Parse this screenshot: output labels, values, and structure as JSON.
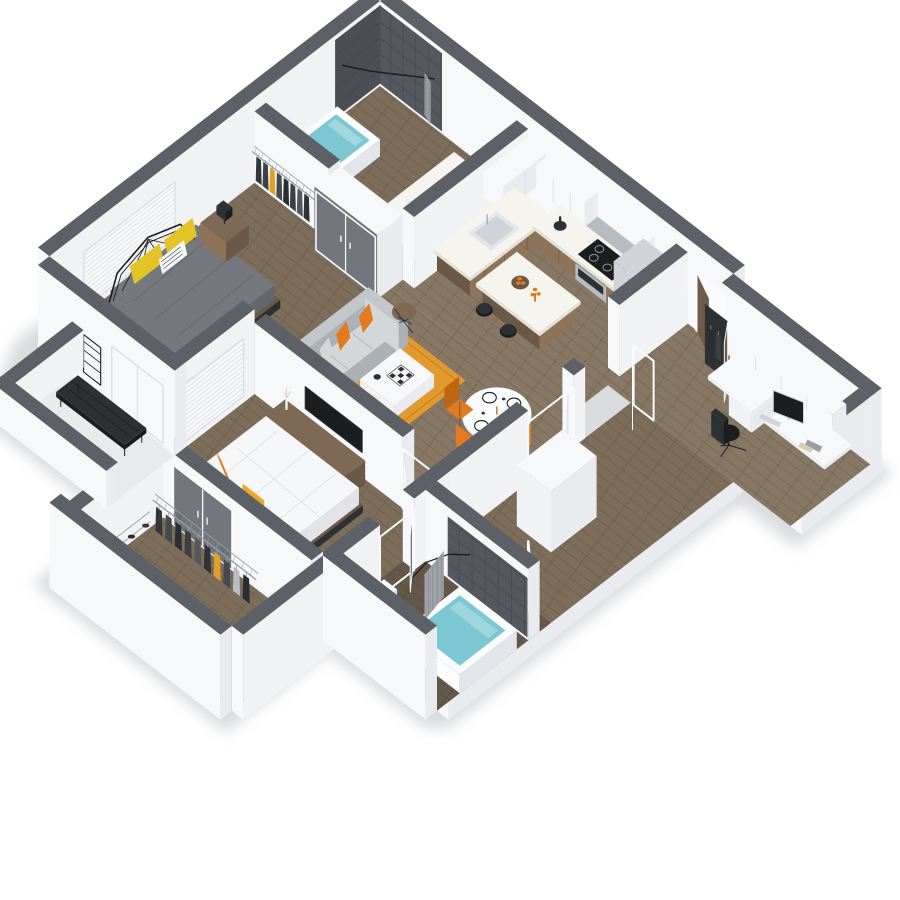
{
  "scene": {
    "type": "isometric-3d-floor-plan",
    "background": "#ffffff"
  },
  "palette": {
    "shadow": "#b9bdc1",
    "cap": "#5d6167",
    "cap_dk": "#53575d",
    "wall_lt": "#f7f8f9",
    "wall_md": "#e9ebee",
    "wall_dk": "#dcdfe3",
    "wall_face": "#f1f2f4",
    "floor_a": "#7d6e5c",
    "floor_b": "#877765",
    "floor_dark": "#64584a",
    "balcony": "#e8eaec",
    "tile_dark": "#55595f",
    "tile_dk2": "#4b4f55",
    "tile_line": "#45494f",
    "water": "#7cc7d2",
    "water_hi": "#b8e2e8",
    "white_fix": "#fbfcfd",
    "fix_shade": "#e2e5e9",
    "wood_cab": "#8d7458",
    "wood_dk": "#6b5947",
    "wood_mid": "#7e6a54",
    "counter": "#f6f4ee",
    "counter_sd": "#e5e2d8",
    "steel": "#b7bcc1",
    "steel_dk": "#989ea5",
    "steel_lt": "#d0d4d8",
    "black": "#1b1d1f",
    "dark": "#2e3134",
    "sofa": "#c3c7cb",
    "sofa_dk": "#acb1b6",
    "sofa_lt": "#d4d7da",
    "orange": "#e27b1e",
    "orange_dk": "#c2650f",
    "amber": "#eda82c",
    "yellow": "#e3c428",
    "rug": "#e09a2e",
    "rug_dk": "#c9831c",
    "cream": "#ece3cf",
    "cream_dk": "#d8ccb1",
    "duvet": "#75787c",
    "duvet_dk": "#63666a",
    "bed_white": "#f6f7f8",
    "bed_sh": "#e1e3e7",
    "door_gray": "#73777d",
    "door_gray_dk": "#62666c",
    "door_brown": "#6e5b49",
    "frame": "#fafbfc",
    "curtain": "#9ea3a9",
    "curtain_dk": "#868b92",
    "clothes": [
      "#33363a",
      "#46494e",
      "#2a2d31",
      "#54585d",
      "#dfa227",
      "#3c3f44",
      "#b9bcc0",
      "#2f3236"
    ]
  },
  "rooms": [
    {
      "id": "bedroom-1",
      "furniture": [
        "bed",
        "yellow-pillows",
        "nightstand",
        "table-lamp",
        "window-blinds",
        "wardrobe-doors"
      ]
    },
    {
      "id": "bathroom-1",
      "furniture": [
        "tiled-walk-in-shower",
        "curved-shower-rod",
        "bathtub",
        "vanity-sink"
      ]
    },
    {
      "id": "linen-closet",
      "furniture": [
        "wire-shelving",
        "hanging-clothes"
      ]
    },
    {
      "id": "kitchen",
      "furniture": [
        "upper-cabinets",
        "microwave",
        "range",
        "cooktop",
        "refrigerator",
        "sink",
        "island",
        "bar-stools"
      ]
    },
    {
      "id": "entry",
      "furniture": [
        "front-door"
      ]
    },
    {
      "id": "office-nook",
      "furniture": [
        "upper-cabinets",
        "desk",
        "monitor",
        "keyboard",
        "drawer-unit",
        "office-chair",
        "leaning-mirror"
      ]
    },
    {
      "id": "living-room",
      "furniture": [
        "sofa",
        "orange-pillows",
        "coffee-table",
        "chessboard",
        "pouf",
        "rug",
        "side-table"
      ]
    },
    {
      "id": "dining-area",
      "furniture": [
        "round-pedestal-table",
        "place-settings",
        "orange-chairs"
      ]
    },
    {
      "id": "hallway",
      "furniture": [
        "utility-closet",
        "wire-linen-shelves",
        "doors"
      ]
    },
    {
      "id": "master-bedroom",
      "furniture": [
        "white-bed",
        "orange-pillows",
        "dresser",
        "tv",
        "vase",
        "window-blinds"
      ]
    },
    {
      "id": "bathroom-2",
      "furniture": [
        "bathtub",
        "shower-curtain",
        "curved-rod",
        "toilet",
        "pedestal-sink"
      ]
    },
    {
      "id": "walk-in-closet",
      "furniture": [
        "clothes-rail",
        "hanging-clothes",
        "shoe-rack",
        "gray-double-doors"
      ]
    },
    {
      "id": "balcony",
      "furniture": [
        "slat-bench",
        "plant-rack"
      ]
    }
  ]
}
